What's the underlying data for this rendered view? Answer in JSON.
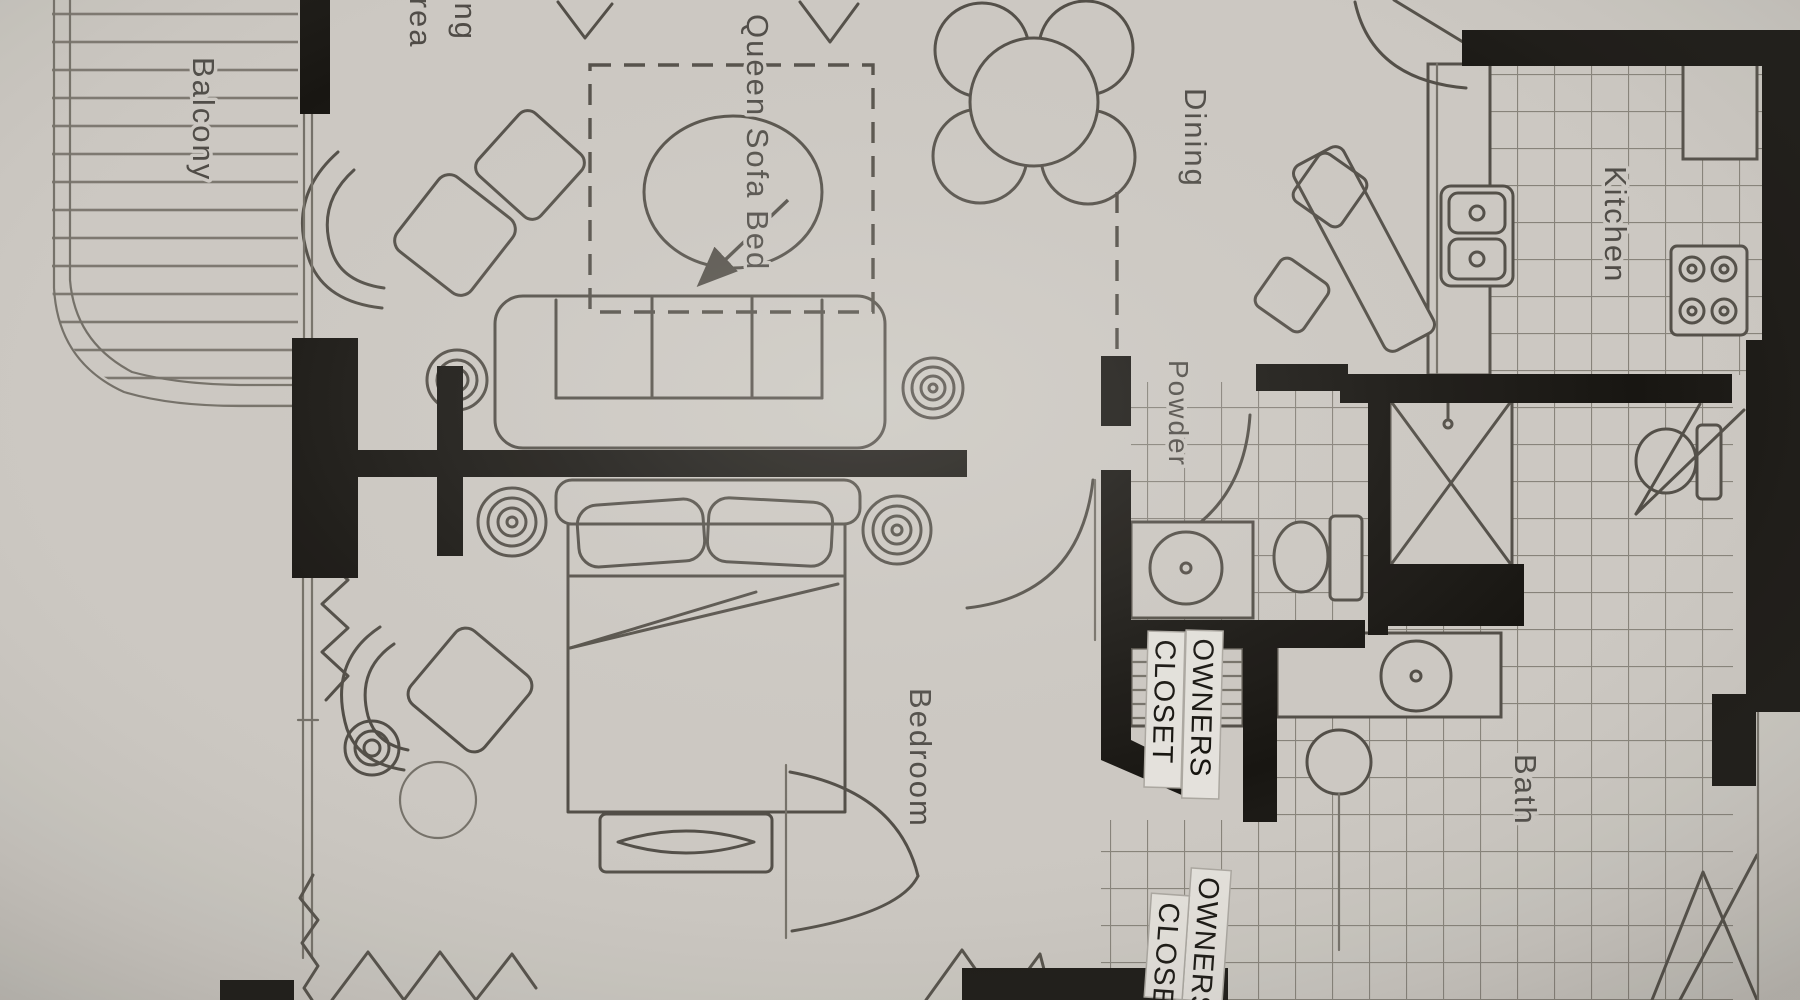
{
  "page": {
    "title": "Condo Floor Plan",
    "type": "scanned floor plan photo"
  },
  "rooms": {
    "balcony": {
      "label": "Balcony"
    },
    "living_area": {
      "label_line1": "Living",
      "label_line2": "Area"
    },
    "queen_sofa_bed": {
      "label": "Queen Sofa Bed"
    },
    "dining": {
      "label": "Dining"
    },
    "kitchen": {
      "label": "Kitchen"
    },
    "powder": {
      "label": "Powder"
    },
    "bedroom": {
      "label": "Bedroom"
    },
    "bath": {
      "label": "Bath"
    },
    "owners_closet_upper": {
      "line1": "OWNERS",
      "line2": "CLOSET"
    },
    "owners_closet_lower": {
      "line1": "OWNERS",
      "line2": "CLOSET"
    }
  },
  "colors": {
    "paper": "#d8d5d0",
    "ink": "#57534c",
    "ink-soft": "#7b776f",
    "wall": "#191713",
    "tile": "#8e8a82",
    "deck": "#837f77",
    "room-text": "#403d38",
    "strip": "#f2f0ec",
    "strip-text": "#16140f"
  }
}
